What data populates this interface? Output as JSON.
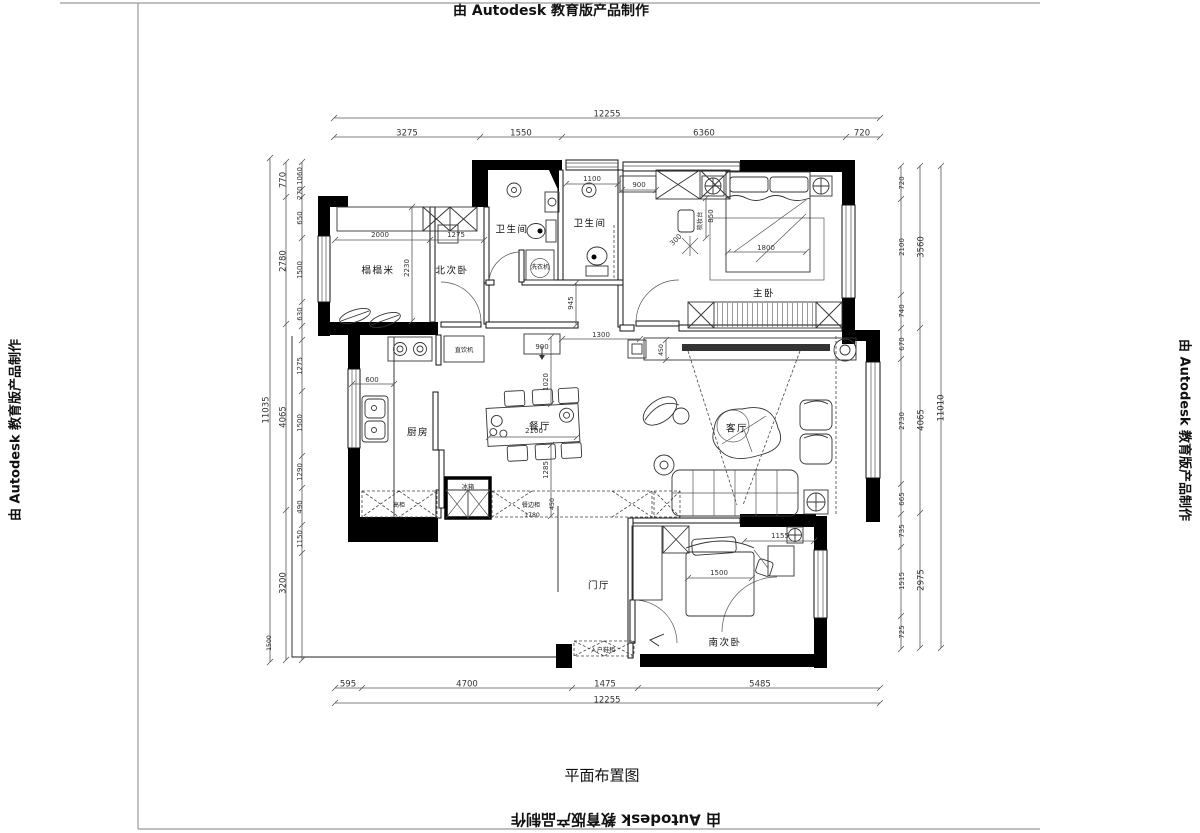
{
  "watermarks": {
    "top": "由 Autodesk 教育版产品制作",
    "bottom": "由 Autodesk 教育版产品制作",
    "left": "由 Autodesk 教育版产品制作",
    "right": "由 Autodesk 教育版产品制作"
  },
  "title": "平面布置图",
  "plan": {
    "labels": [
      {
        "t": "12255",
        "x": 607,
        "y": 114,
        "k": "d"
      },
      {
        "t": "3275",
        "x": 407,
        "y": 133,
        "k": "d"
      },
      {
        "t": "1550",
        "x": 521,
        "y": 133,
        "k": "d"
      },
      {
        "t": "6360",
        "x": 704,
        "y": 133,
        "k": "d"
      },
      {
        "t": "720",
        "x": 862,
        "y": 133,
        "k": "d"
      },
      {
        "t": "595",
        "x": 348,
        "y": 684,
        "k": "d"
      },
      {
        "t": "4700",
        "x": 467,
        "y": 684,
        "k": "d"
      },
      {
        "t": "1475",
        "x": 605,
        "y": 684,
        "k": "d"
      },
      {
        "t": "5485",
        "x": 760,
        "y": 684,
        "k": "d"
      },
      {
        "t": "12255",
        "x": 607,
        "y": 700,
        "k": "d"
      },
      {
        "t": "11035",
        "x": 266,
        "y": 410,
        "r": -90,
        "k": "d"
      },
      {
        "t": "770",
        "x": 283,
        "y": 180,
        "r": -90,
        "k": "d"
      },
      {
        "t": "2780",
        "x": 283,
        "y": 261,
        "r": -90,
        "k": "d"
      },
      {
        "t": "4065",
        "x": 283,
        "y": 417,
        "r": -90,
        "k": "d"
      },
      {
        "t": "3200",
        "x": 283,
        "y": 583,
        "r": -90,
        "k": "d"
      },
      {
        "t": "1060",
        "x": 300,
        "y": 176,
        "r": -90,
        "k": "i"
      },
      {
        "t": "270",
        "x": 300,
        "y": 193,
        "r": -90,
        "k": "i"
      },
      {
        "t": "650",
        "x": 300,
        "y": 218,
        "r": -90,
        "k": "i"
      },
      {
        "t": "1500",
        "x": 300,
        "y": 270,
        "r": -90,
        "k": "i"
      },
      {
        "t": "630",
        "x": 300,
        "y": 314,
        "r": -90,
        "k": "i"
      },
      {
        "t": "1275",
        "x": 300,
        "y": 366,
        "r": -90,
        "k": "i"
      },
      {
        "t": "1500",
        "x": 300,
        "y": 423,
        "r": -90,
        "k": "i"
      },
      {
        "t": "1290",
        "x": 300,
        "y": 472,
        "r": -90,
        "k": "i"
      },
      {
        "t": "490",
        "x": 300,
        "y": 507,
        "r": -90,
        "k": "i"
      },
      {
        "t": "1150",
        "x": 300,
        "y": 539,
        "r": -90,
        "k": "i"
      },
      {
        "t": "1500",
        "x": 269,
        "y": 643,
        "r": -90,
        "k": "t"
      },
      {
        "t": "720",
        "x": 902,
        "y": 183,
        "r": -90,
        "k": "i"
      },
      {
        "t": "2100",
        "x": 902,
        "y": 247,
        "r": -90,
        "k": "i"
      },
      {
        "t": "740",
        "x": 902,
        "y": 311,
        "r": -90,
        "k": "i"
      },
      {
        "t": "670",
        "x": 902,
        "y": 344,
        "r": -90,
        "k": "i"
      },
      {
        "t": "2730",
        "x": 902,
        "y": 421,
        "r": -90,
        "k": "i"
      },
      {
        "t": "665",
        "x": 902,
        "y": 499,
        "r": -90,
        "k": "i"
      },
      {
        "t": "735",
        "x": 902,
        "y": 531,
        "r": -90,
        "k": "i"
      },
      {
        "t": "1515",
        "x": 902,
        "y": 581,
        "r": -90,
        "k": "i"
      },
      {
        "t": "725",
        "x": 902,
        "y": 632,
        "r": -90,
        "k": "i"
      },
      {
        "t": "3560",
        "x": 921,
        "y": 247,
        "r": -90,
        "k": "d"
      },
      {
        "t": "4065",
        "x": 921,
        "y": 420,
        "r": -90,
        "k": "d"
      },
      {
        "t": "2975",
        "x": 921,
        "y": 580,
        "r": -90,
        "k": "d"
      },
      {
        "t": "11010",
        "x": 941,
        "y": 408,
        "r": -90,
        "k": "d"
      },
      {
        "t": "2000",
        "x": 380,
        "y": 235,
        "k": "i"
      },
      {
        "t": "1275",
        "x": 456,
        "y": 235,
        "k": "i"
      },
      {
        "t": "2230",
        "x": 407,
        "y": 268,
        "r": -90,
        "k": "i"
      },
      {
        "t": "1100",
        "x": 592,
        "y": 179,
        "k": "i"
      },
      {
        "t": "900",
        "x": 639,
        "y": 185,
        "k": "i"
      },
      {
        "t": "850",
        "x": 711,
        "y": 216,
        "r": -90,
        "k": "i"
      },
      {
        "t": "300",
        "x": 676,
        "y": 240,
        "r": -45,
        "k": "i"
      },
      {
        "t": "1800",
        "x": 766,
        "y": 248,
        "k": "i"
      },
      {
        "t": "945",
        "x": 571,
        "y": 303,
        "r": -90,
        "k": "i"
      },
      {
        "t": "900",
        "x": 542,
        "y": 347,
        "k": "i"
      },
      {
        "t": "1300",
        "x": 601,
        "y": 335,
        "k": "i"
      },
      {
        "t": "600",
        "x": 372,
        "y": 380,
        "k": "i"
      },
      {
        "t": "2100",
        "x": 534,
        "y": 431,
        "k": "i"
      },
      {
        "t": "1020",
        "x": 546,
        "y": 382,
        "r": -90,
        "k": "i"
      },
      {
        "t": "1285",
        "x": 546,
        "y": 470,
        "r": -90,
        "k": "i"
      },
      {
        "t": "450",
        "x": 661,
        "y": 350,
        "r": -90,
        "k": "t"
      },
      {
        "t": "1780",
        "x": 532,
        "y": 515,
        "k": "t"
      },
      {
        "t": "450",
        "x": 552,
        "y": 504,
        "r": -90,
        "k": "t"
      },
      {
        "t": "1500",
        "x": 719,
        "y": 573,
        "k": "i"
      },
      {
        "t": "1155",
        "x": 780,
        "y": 536,
        "k": "i"
      },
      {
        "t": "榻榻米",
        "x": 378,
        "y": 271,
        "k": "r"
      },
      {
        "t": "北次卧",
        "x": 452,
        "y": 271,
        "k": "r"
      },
      {
        "t": "卫生间",
        "x": 512,
        "y": 230,
        "k": "r"
      },
      {
        "t": "卫生间",
        "x": 590,
        "y": 224,
        "k": "r"
      },
      {
        "t": "主卧",
        "x": 764,
        "y": 294,
        "k": "r"
      },
      {
        "t": "厨房",
        "x": 418,
        "y": 433,
        "k": "r"
      },
      {
        "t": "餐厅",
        "x": 540,
        "y": 427,
        "k": "r"
      },
      {
        "t": "客厅",
        "x": 737,
        "y": 429,
        "k": "r"
      },
      {
        "t": "门厅",
        "x": 599,
        "y": 586,
        "k": "r"
      },
      {
        "t": "南次卧",
        "x": 725,
        "y": 643,
        "k": "r"
      },
      {
        "t": "洗衣机",
        "x": 540,
        "y": 267,
        "k": "t"
      },
      {
        "t": "直饮机",
        "x": 464,
        "y": 350,
        "k": "t"
      },
      {
        "t": "高柜",
        "x": 399,
        "y": 505,
        "k": "t"
      },
      {
        "t": "冰箱",
        "x": 468,
        "y": 487,
        "k": "t"
      },
      {
        "t": "餐边柜",
        "x": 531,
        "y": 505,
        "k": "t"
      },
      {
        "t": "入户鞋柜",
        "x": 603,
        "y": 650,
        "k": "t"
      },
      {
        "t": "梳妆台",
        "x": 700,
        "y": 221,
        "r": -90,
        "k": "t"
      }
    ],
    "chains": [
      {
        "o": "h",
        "p": 118,
        "a": 334,
        "b": 880,
        "t": [
          334,
          880
        ]
      },
      {
        "o": "h",
        "p": 137,
        "a": 334,
        "b": 880,
        "t": [
          334,
          480,
          562,
          846,
          880
        ]
      },
      {
        "o": "h",
        "p": 688,
        "a": 335,
        "b": 880,
        "t": [
          335,
          362,
          572,
          638,
          880
        ]
      },
      {
        "o": "h",
        "p": 703,
        "a": 335,
        "b": 880,
        "t": [
          335,
          880
        ]
      },
      {
        "o": "v",
        "p": 270,
        "a": 158,
        "b": 662,
        "t": [
          158,
          662
        ]
      },
      {
        "o": "v",
        "p": 286,
        "a": 162,
        "b": 660,
        "t": [
          162,
          197,
          324,
          510,
          660
        ]
      },
      {
        "o": "v",
        "p": 302,
        "a": 162,
        "b": 660,
        "t": [
          162,
          189,
          197,
          238,
          302,
          326,
          340,
          391,
          456,
          488,
          525,
          553,
          660
        ]
      },
      {
        "o": "v",
        "p": 901,
        "a": 166,
        "b": 649,
        "t": [
          166,
          199,
          295,
          328,
          359,
          484,
          514,
          547,
          616,
          649
        ]
      },
      {
        "o": "v",
        "p": 920,
        "a": 166,
        "b": 648,
        "t": [
          166,
          328,
          513,
          648
        ]
      },
      {
        "o": "v",
        "p": 941,
        "a": 166,
        "b": 648,
        "t": [
          166,
          648
        ]
      },
      {
        "o": "h",
        "p": 240,
        "a": 335,
        "b": 484,
        "t": [
          335,
          430,
          484
        ]
      },
      {
        "o": "v",
        "p": 412,
        "a": 207,
        "b": 321,
        "t": [
          207,
          321
        ]
      },
      {
        "o": "h",
        "p": 184,
        "a": 566,
        "b": 618,
        "t": [
          566,
          618
        ]
      },
      {
        "o": "h",
        "p": 190,
        "a": 622,
        "b": 656,
        "t": [
          622,
          656
        ]
      },
      {
        "o": "v",
        "p": 706,
        "a": 198,
        "b": 238,
        "t": [
          198,
          238
        ]
      },
      {
        "o": "h",
        "p": 252,
        "a": 728,
        "b": 806,
        "t": [
          728,
          806
        ]
      },
      {
        "o": "v",
        "p": 576,
        "a": 283,
        "b": 325,
        "t": [
          283,
          325
        ]
      },
      {
        "o": "h",
        "p": 339,
        "a": 562,
        "b": 640,
        "t": [
          562,
          640
        ]
      },
      {
        "o": "h",
        "p": 384,
        "a": 352,
        "b": 394,
        "t": [
          352,
          394
        ]
      },
      {
        "o": "h",
        "p": 437,
        "a": 489,
        "b": 577,
        "t": [
          489,
          577
        ]
      },
      {
        "o": "v",
        "p": 551,
        "a": 337,
        "b": 404,
        "t": [
          337,
          404
        ]
      },
      {
        "o": "v",
        "p": 551,
        "a": 445,
        "b": 516,
        "t": [
          445,
          516
        ]
      },
      {
        "o": "v",
        "p": 666,
        "a": 340,
        "b": 360,
        "t": [
          340,
          360
        ]
      },
      {
        "o": "h",
        "p": 578,
        "a": 688,
        "b": 752,
        "t": [
          688,
          752
        ]
      },
      {
        "o": "h",
        "p": 541,
        "a": 744,
        "b": 814,
        "t": [
          744,
          814
        ]
      }
    ]
  }
}
